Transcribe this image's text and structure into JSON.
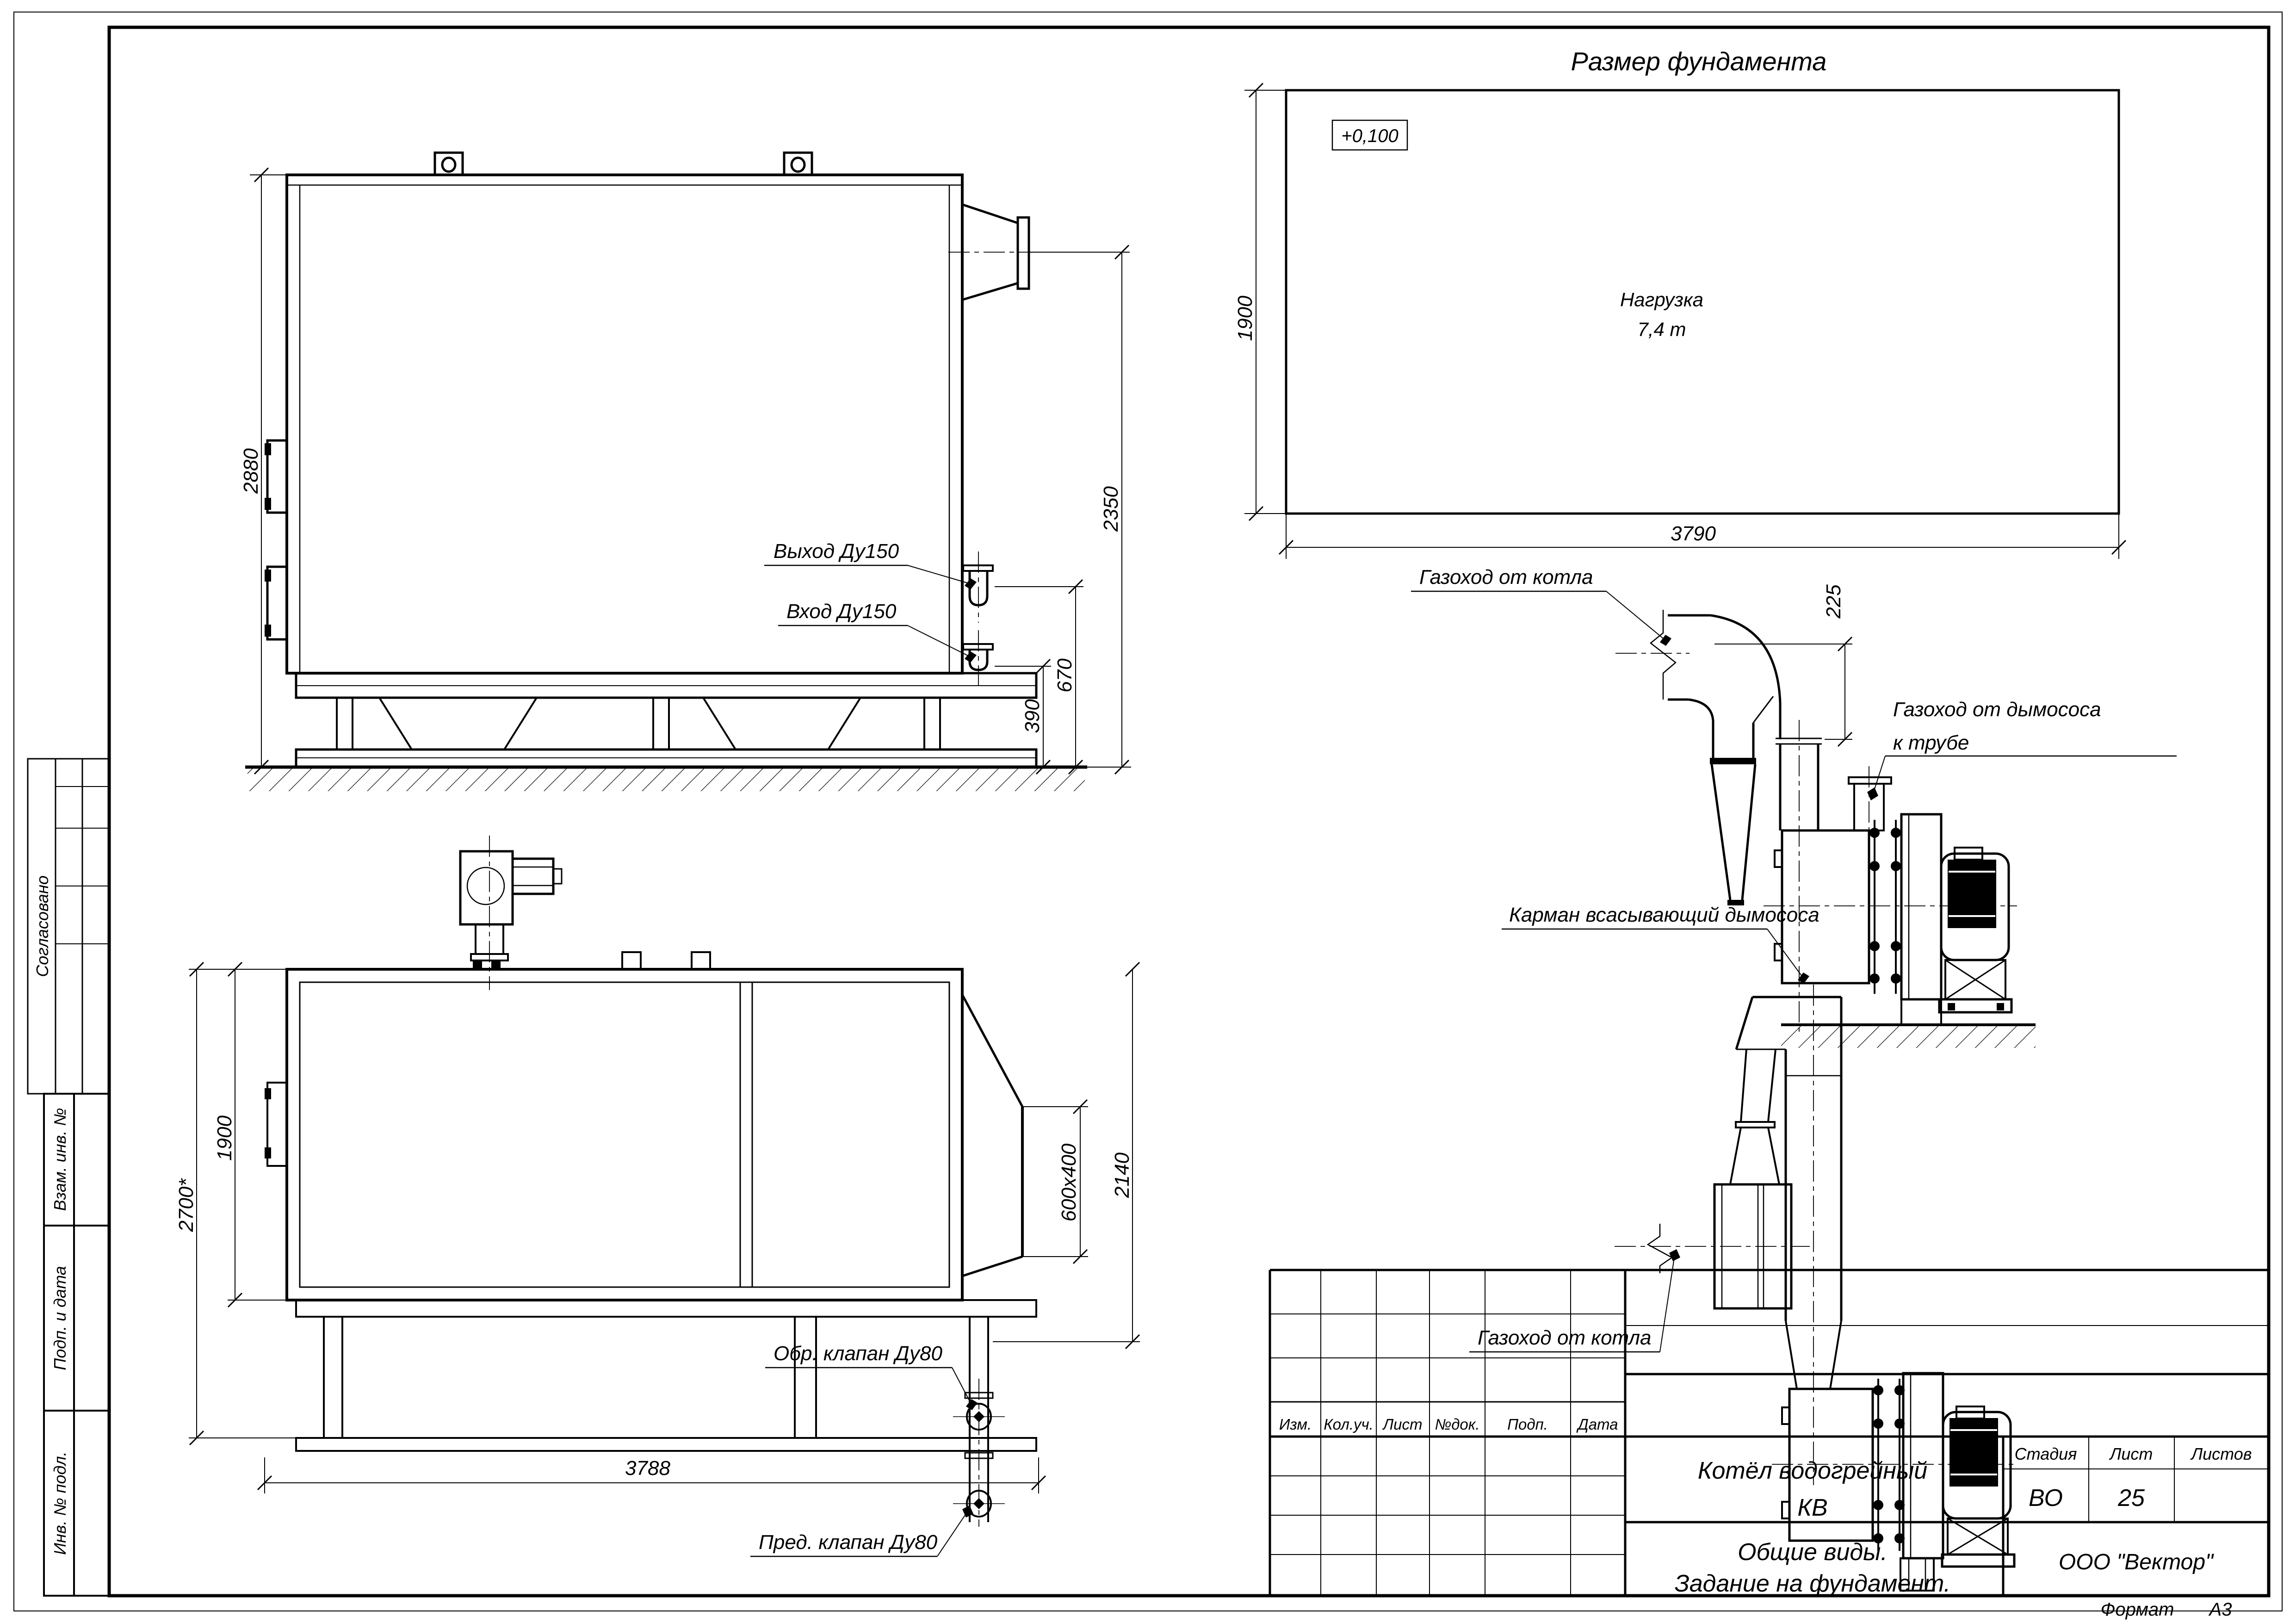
{
  "sheet": {
    "format_label": "Формат",
    "format_value": "А3"
  },
  "stamp_side": {
    "soglasovano": "Согласовано",
    "vzam": "Взам. инв. №",
    "podp": "Подп. и дата",
    "inv": "Инв. № подл."
  },
  "title_block": {
    "rev_headers": [
      "Изм.",
      "Кол.уч.",
      "Лист",
      "№док.",
      "Подп.",
      "Дата"
    ],
    "doc_title_line1": "Котёл водогрейный",
    "doc_title_line2": "КВ",
    "stage_label": "Стадия",
    "sheet_label": "Лист",
    "sheets_label": "Листов",
    "stage_value": "ВО",
    "sheet_value": "25",
    "sheets_value": "",
    "subtitle_line1": "Общие виды.",
    "subtitle_line2": "Задание на фундамент.",
    "company": "ООО \"Вектор\""
  },
  "foundation": {
    "title": "Размер фундамента",
    "elevation": "+0,100",
    "load_line1": "Нагрузка",
    "load_line2": "7,4 т",
    "dim_height": "1900",
    "dim_width": "3790"
  },
  "side_view": {
    "dim_height": "2880",
    "dim_right": "2350",
    "dim_670": "670",
    "dim_390": "390",
    "label_out": "Выход Ду150",
    "label_in": "Вход Ду150"
  },
  "plan_view": {
    "dim_2700": "2700*",
    "dim_1900": "1900",
    "dim_3788": "3788",
    "dim_600x400": "600x400",
    "dim_2140": "2140",
    "label_check_valve": "Обр. клапан Ду80",
    "label_safety_valve": "Пред. клапан Ду80"
  },
  "duct_side": {
    "label_from_boiler": "Газоход от котла",
    "dim_225": "225",
    "label_to_stack_line1": "Газоход от дымососа",
    "label_to_stack_line2": "к трубе",
    "label_pocket": "Карман всасывающий дымососа"
  },
  "duct_plan": {
    "label_from_boiler": "Газоход от котла"
  }
}
